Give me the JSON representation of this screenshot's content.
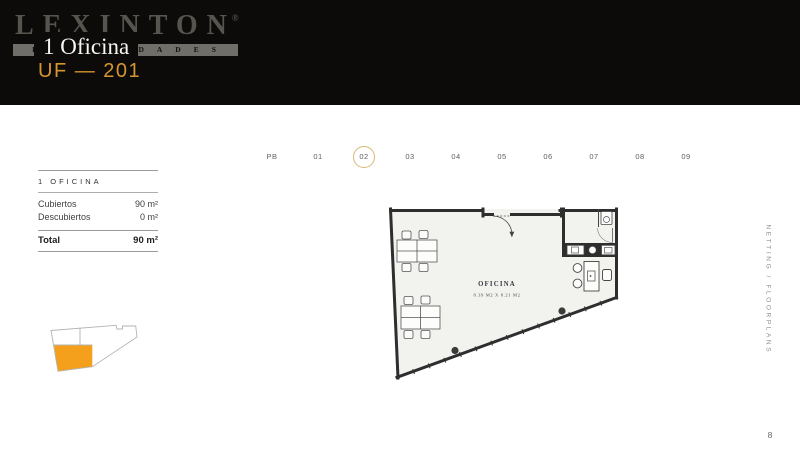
{
  "header": {
    "brand": "LEXINTON",
    "registered": "®",
    "brand_sub": "PROPIEDADES",
    "unit_title": "1 Oficina",
    "unit_code": "UF — 201"
  },
  "floor_selector": {
    "floors": [
      "PB",
      "01",
      "02",
      "03",
      "04",
      "05",
      "06",
      "07",
      "08",
      "09"
    ],
    "active": "02",
    "ring_color": "#D8B873"
  },
  "info_panel": {
    "title": "1 OFICINA",
    "rows": [
      {
        "label": "Cubiertos",
        "value": "90 m²"
      },
      {
        "label": "Descubiertos",
        "value": "0 m²"
      }
    ],
    "total": {
      "label": "Total",
      "value": "90 m²"
    }
  },
  "floor_plan": {
    "room_label": "OFICINA",
    "room_dims": "8.39 M2 X 8.21 M2"
  },
  "key_plan": {
    "highlight_color": "#F4A01C"
  },
  "side_label": "NETTING / FLOORPLANS",
  "page_number": "8",
  "colors": {
    "accent": "#D6952F"
  }
}
